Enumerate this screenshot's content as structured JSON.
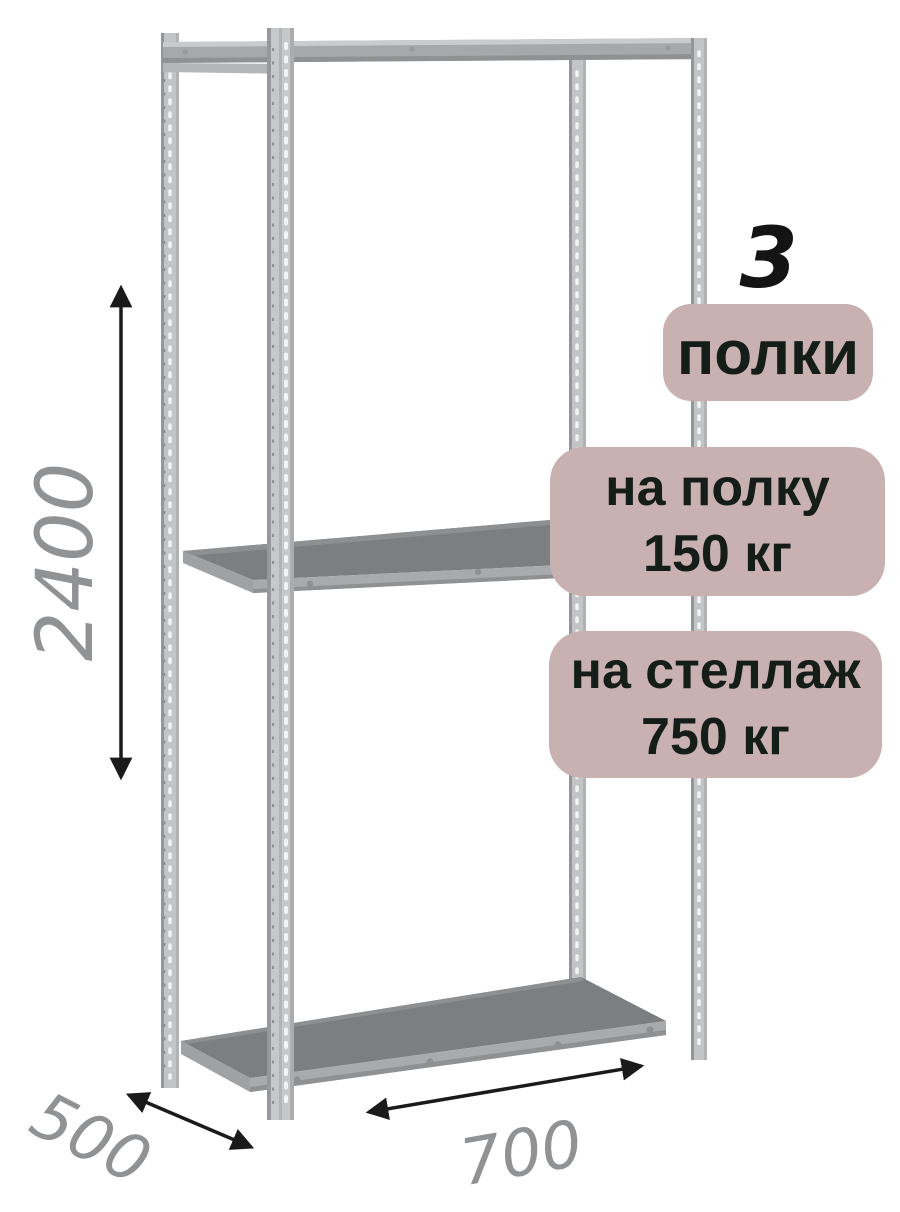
{
  "dimensions": {
    "height_mm": "2400",
    "depth_mm": "500",
    "width_mm": "700"
  },
  "badges": {
    "shelf_count": {
      "number": "3",
      "label": "полки"
    },
    "per_shelf": {
      "line1": "на полку",
      "line2": "150 кг"
    },
    "per_rack": {
      "line1": "на стеллаж",
      "line2": "750 кг"
    }
  },
  "colors": {
    "background": "#ffffff",
    "badge_bg": "#c9b1b1",
    "badge_text": "#151d18",
    "dimension_text": "#909294",
    "arrow": "#1a1a1a",
    "metal_post": "#c3c5c7",
    "metal_beam": "#a6a8aa",
    "shelf_top": "#7c7e80"
  }
}
